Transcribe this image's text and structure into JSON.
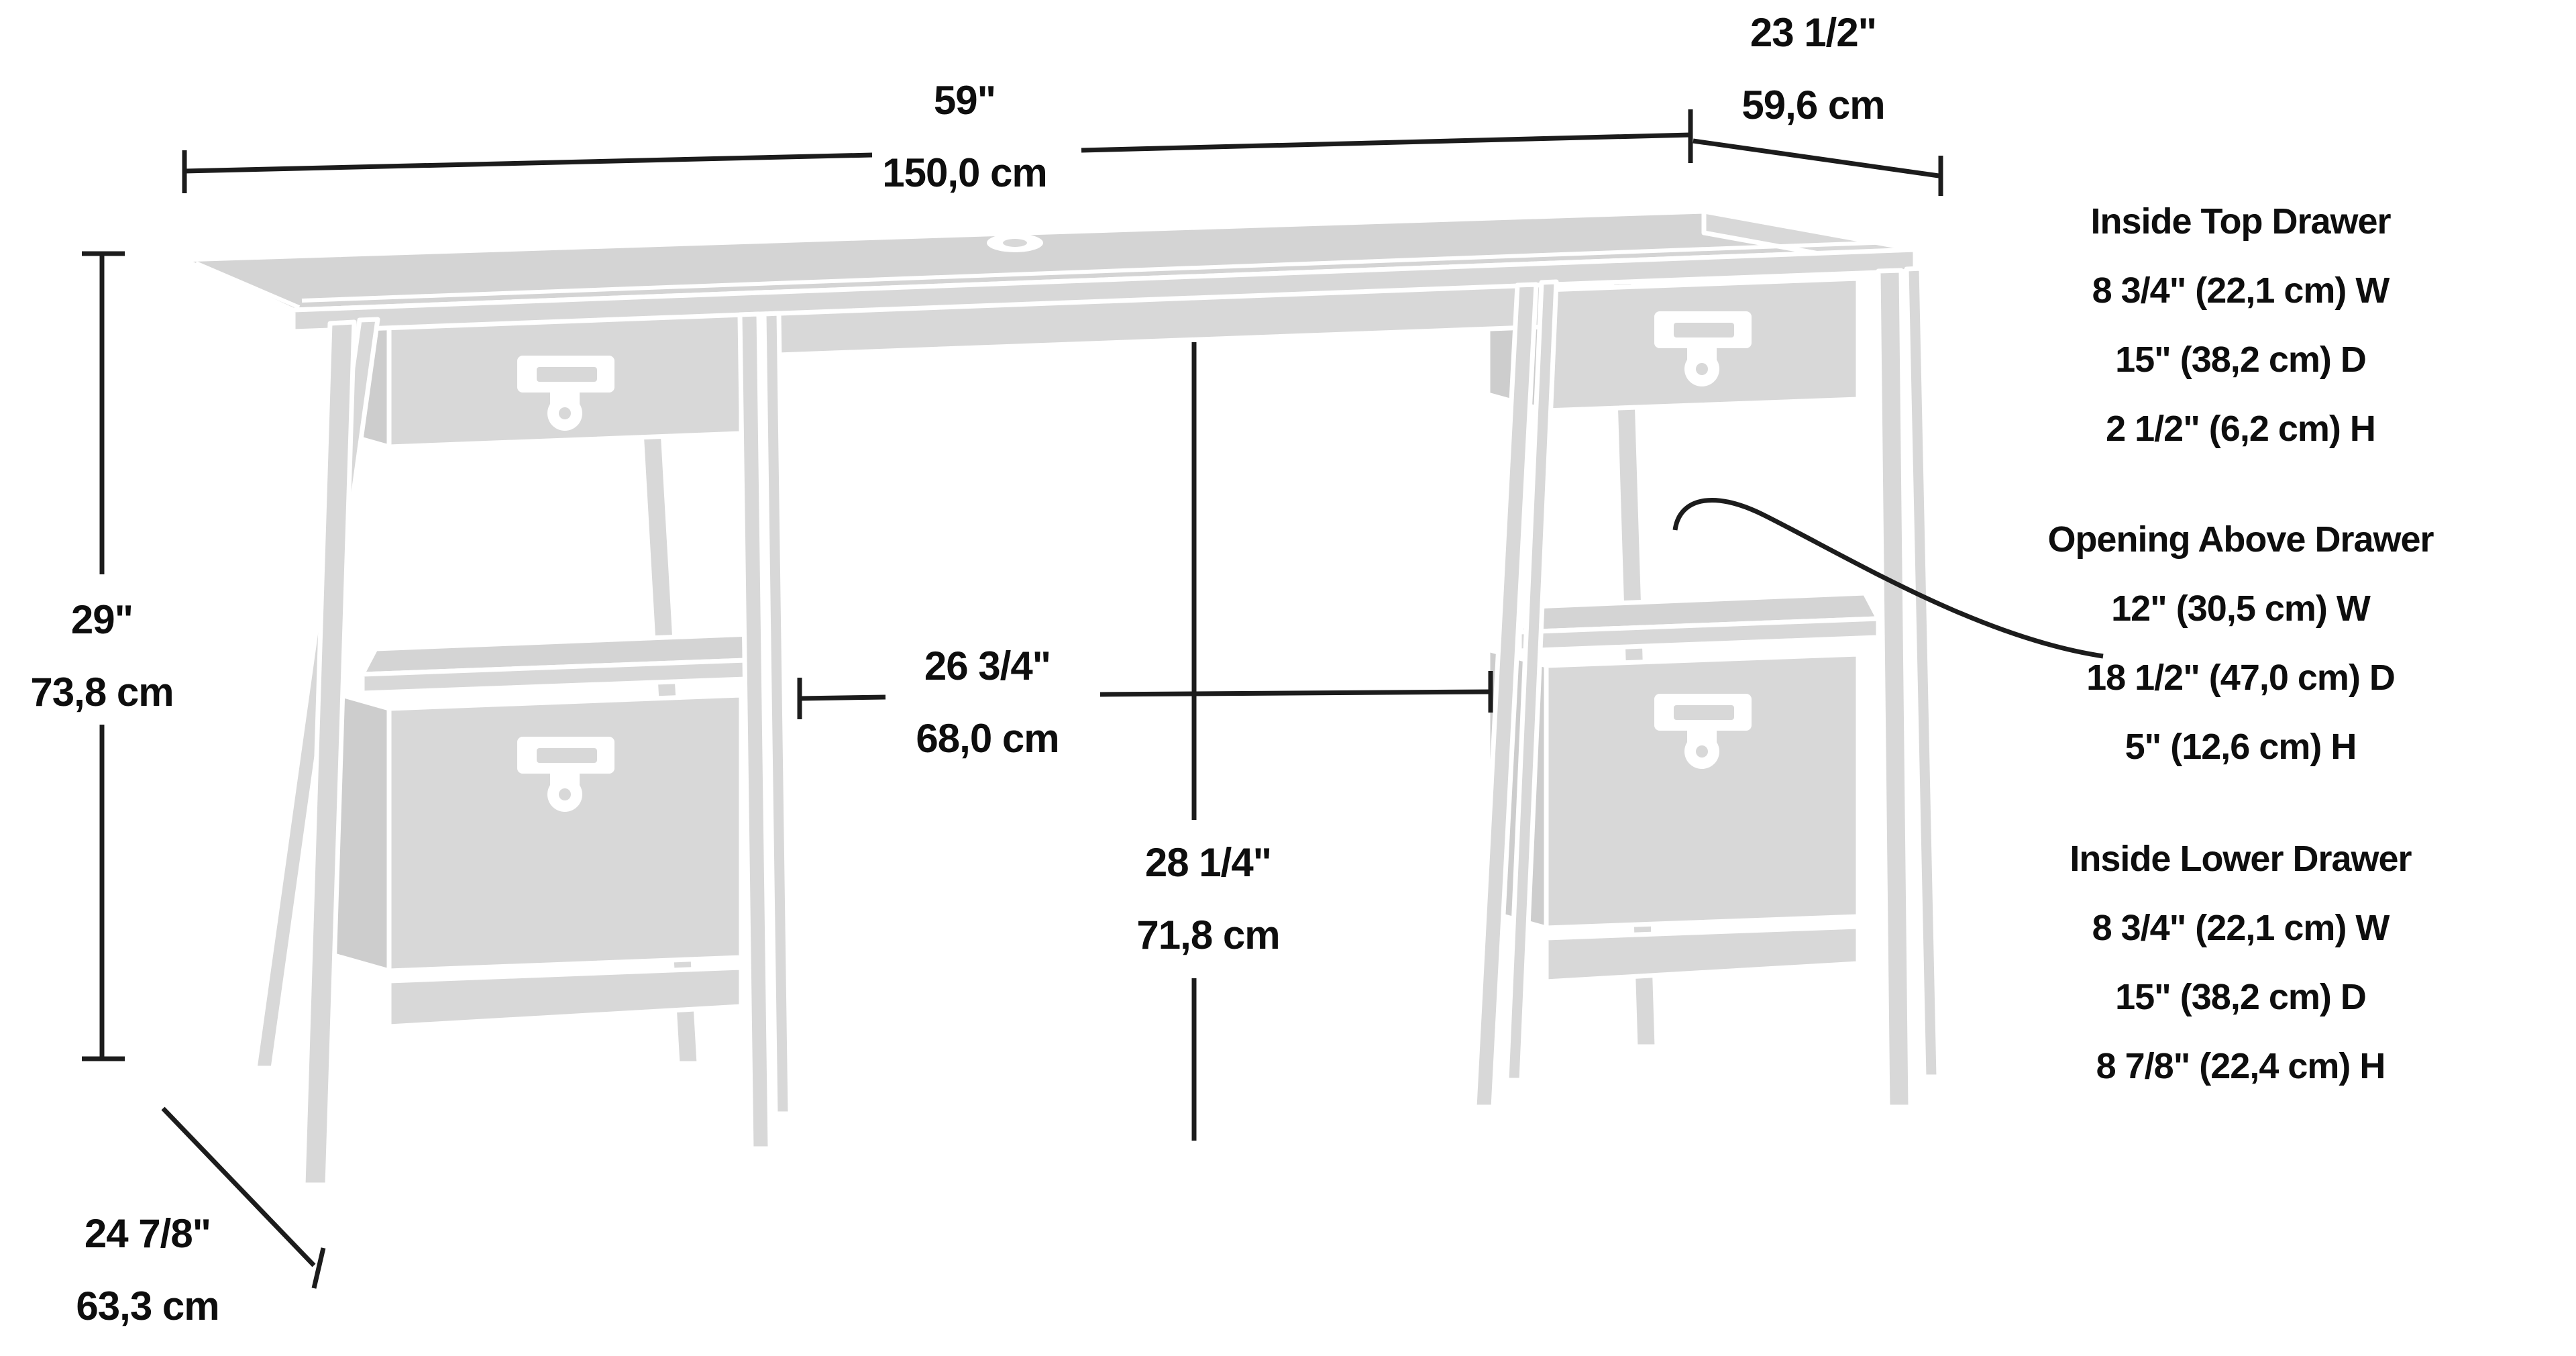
{
  "colors": {
    "background": "#ffffff",
    "desk_fill": "#d8d8d8",
    "desk_side": "#cdcdcd",
    "desk_top": "#d4d4d4",
    "dimension_line": "#1c1c1c",
    "text": "#0e0e0e"
  },
  "dimensions": {
    "width": {
      "imperial": "59\"",
      "metric": "150,0 cm"
    },
    "depth": {
      "imperial": "23 1/2\"",
      "metric": "59,6 cm"
    },
    "height": {
      "imperial": "29\"",
      "metric": "73,8 cm"
    },
    "floor_depth": {
      "imperial": "24 7/8\"",
      "metric": "63,3 cm"
    },
    "knee_space_width": {
      "imperial": "26 3/4\"",
      "metric": "68,0 cm"
    },
    "knee_space_height": {
      "imperial": "28 1/4\"",
      "metric": "71,8 cm"
    }
  },
  "annotations": {
    "inside_top_drawer": {
      "title": "Inside Top Drawer",
      "lines": [
        "8 3/4\" (22,1 cm) W",
        "15\" (38,2 cm) D",
        "2 1/2\" (6,2 cm) H"
      ]
    },
    "opening_above_drawer": {
      "title": "Opening Above Drawer",
      "lines": [
        "12\" (30,5 cm) W",
        "18 1/2\" (47,0 cm) D",
        "5\" (12,6 cm) H"
      ]
    },
    "inside_lower_drawer": {
      "title": "Inside Lower Drawer",
      "lines": [
        "8 3/4\" (22,1 cm) W",
        "15\" (38,2 cm) D",
        "8 7/8\" (22,4 cm) H"
      ]
    }
  }
}
